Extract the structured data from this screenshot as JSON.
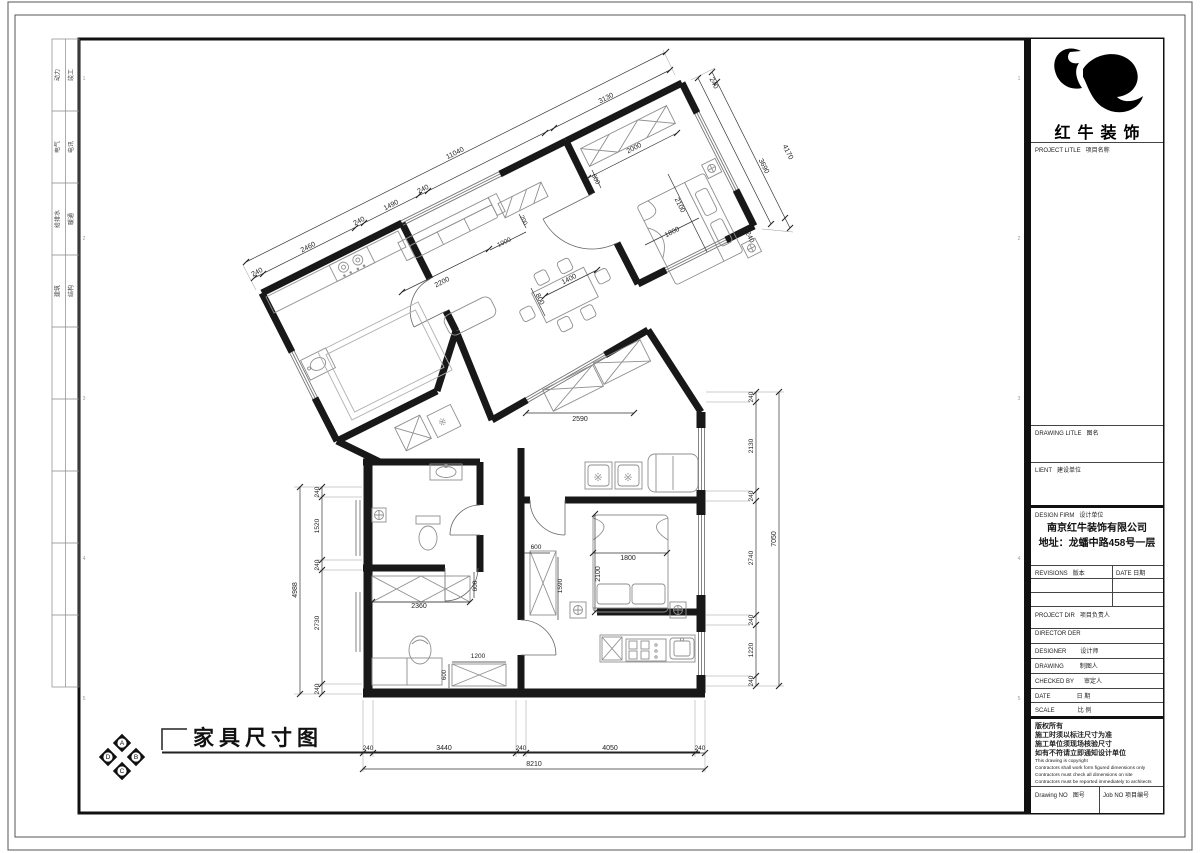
{
  "brand": {
    "name": "红牛装饰"
  },
  "title": {
    "text": "家具尺寸图"
  },
  "compass": {
    "letters": [
      "A",
      "B",
      "C",
      "D"
    ]
  },
  "disciplines": [
    [
      "动力",
      "竣工"
    ],
    [
      "电气",
      "电讯"
    ],
    [
      "给排水",
      "暖通"
    ],
    [
      "建筑",
      "结构"
    ]
  ],
  "titleblock": {
    "project_title": {
      "en": "PROJECT LITLE",
      "zh": "项目名称"
    },
    "drawing_title": {
      "en": "DRAWING LITLE",
      "zh": "图名"
    },
    "client": {
      "en": "LIENT",
      "zh": "建设单位"
    },
    "design_firm": {
      "en": "DESIGN FIRM",
      "zh": "设计单位"
    },
    "company_line1": "南京红牛装饰有限公司",
    "company_line2": "地址：龙蟠中路458号一层",
    "revisions": {
      "en": "REVISIONS",
      "zh": "版本"
    },
    "rev_date": {
      "en": "DATE",
      "zh": "日期"
    },
    "project_dir": {
      "en": "PROJECT DIR",
      "zh": "项目负责人"
    },
    "director": {
      "en": "DIRECTOR DER",
      "zh": ""
    },
    "designer": {
      "en": "DESIGNER",
      "zh": "设计师"
    },
    "drawing_by": {
      "en": "DRAWING",
      "zh": "制图人"
    },
    "checked_by": {
      "en": "CHECKED BY",
      "zh": "审定人"
    },
    "date": {
      "en": "DATE",
      "zh": "日  期"
    },
    "scale": {
      "en": "SCALE",
      "zh": "比  例"
    },
    "drawing_no": {
      "en": "Drawing NO",
      "zh": "图号"
    },
    "job_no": {
      "en": "Job NO",
      "zh": "项目编号"
    },
    "copyright_zh": [
      "版权所有",
      "施工时须以标注尺寸为准",
      "施工单位须现场核验尺寸",
      "如有不符请立即通知设计单位"
    ],
    "copyright_en": [
      "This drawing is copyright",
      "Contractors shall work form figured dimensions only",
      "Contractors must check all dimensions on site",
      "Contractors must be reported immediately to architects"
    ]
  },
  "plan_labels": [
    {
      "t": "240",
      "x": 258,
      "y": 274,
      "r": -27,
      "s": 7
    },
    {
      "t": "2460",
      "x": 309,
      "y": 249,
      "r": -27,
      "s": 7
    },
    {
      "t": "240",
      "x": 360,
      "y": 223,
      "r": -27,
      "s": 7
    },
    {
      "t": "1490",
      "x": 392,
      "y": 207,
      "r": -27,
      "s": 7
    },
    {
      "t": "240",
      "x": 424,
      "y": 191,
      "r": -27,
      "s": 7
    },
    {
      "t": "3130",
      "x": 607,
      "y": 100,
      "r": -27,
      "s": 7
    },
    {
      "t": "11040",
      "x": 456,
      "y": 155,
      "r": -27,
      "s": 7
    },
    {
      "t": "240",
      "x": 712,
      "y": 84,
      "r": 63,
      "s": 7
    },
    {
      "t": "3690",
      "x": 762,
      "y": 167,
      "r": 63,
      "s": 7
    },
    {
      "t": "4170",
      "x": 786,
      "y": 153,
      "r": 63,
      "s": 7
    },
    {
      "t": "240",
      "x": 748,
      "y": 238,
      "r": 63,
      "s": 7
    },
    {
      "t": "2000",
      "x": 635,
      "y": 150,
      "r": -27,
      "s": 7
    },
    {
      "t": "600",
      "x": 594,
      "y": 180,
      "r": 63,
      "s": 6.5
    },
    {
      "t": "2100",
      "x": 678,
      "y": 206,
      "r": 63,
      "s": 7
    },
    {
      "t": "1800",
      "x": 673,
      "y": 234,
      "r": -27,
      "s": 7
    },
    {
      "t": "2200",
      "x": 443,
      "y": 284,
      "r": -27,
      "s": 7
    },
    {
      "t": "1000",
      "x": 505,
      "y": 244,
      "r": -27,
      "s": 6.5
    },
    {
      "t": "200",
      "x": 522,
      "y": 221,
      "r": 63,
      "s": 6
    },
    {
      "t": "1400",
      "x": 570,
      "y": 281,
      "r": -27,
      "s": 7
    },
    {
      "t": "800",
      "x": 538,
      "y": 300,
      "r": 63,
      "s": 7
    },
    {
      "t": "2590",
      "x": 580,
      "y": 421,
      "r": 0,
      "s": 7
    },
    {
      "t": "600",
      "x": 536,
      "y": 549,
      "r": 0,
      "s": 6.5
    },
    {
      "t": "1590",
      "x": 562,
      "y": 586,
      "r": -90,
      "s": 6.5
    },
    {
      "t": "1800",
      "x": 628,
      "y": 560,
      "r": 0,
      "s": 7
    },
    {
      "t": "2100",
      "x": 600,
      "y": 574,
      "r": -90,
      "s": 7
    },
    {
      "t": "2360",
      "x": 419,
      "y": 608,
      "r": 0,
      "s": 7
    },
    {
      "t": "600",
      "x": 477,
      "y": 586,
      "r": -90,
      "s": 6.5
    },
    {
      "t": "1200",
      "x": 478,
      "y": 658,
      "r": 0,
      "s": 6.5
    },
    {
      "t": "600",
      "x": 446,
      "y": 675,
      "r": -90,
      "s": 6
    },
    {
      "t": "240",
      "x": 319,
      "y": 492,
      "r": -90,
      "s": 6.5
    },
    {
      "t": "1520",
      "x": 319,
      "y": 526,
      "r": -90,
      "s": 6.5
    },
    {
      "t": "240",
      "x": 319,
      "y": 565,
      "r": -90,
      "s": 6.5
    },
    {
      "t": "2730",
      "x": 319,
      "y": 623,
      "r": -90,
      "s": 6.5
    },
    {
      "t": "240",
      "x": 319,
      "y": 689,
      "r": -90,
      "s": 6.5
    },
    {
      "t": "4988",
      "x": 297,
      "y": 590,
      "r": -90,
      "s": 7
    },
    {
      "t": "240",
      "x": 753,
      "y": 397,
      "r": -90,
      "s": 6.5
    },
    {
      "t": "2130",
      "x": 753,
      "y": 446,
      "r": -90,
      "s": 6.5
    },
    {
      "t": "240",
      "x": 753,
      "y": 496,
      "r": -90,
      "s": 6.5
    },
    {
      "t": "2740",
      "x": 753,
      "y": 558,
      "r": -90,
      "s": 6.5
    },
    {
      "t": "240",
      "x": 753,
      "y": 620,
      "r": -90,
      "s": 6.5
    },
    {
      "t": "1220",
      "x": 753,
      "y": 650,
      "r": -90,
      "s": 6.5
    },
    {
      "t": "240",
      "x": 753,
      "y": 681,
      "r": -90,
      "s": 6.5
    },
    {
      "t": "7050",
      "x": 776,
      "y": 539,
      "r": -90,
      "s": 7
    },
    {
      "t": "240",
      "x": 368,
      "y": 750,
      "r": 0,
      "s": 6.5
    },
    {
      "t": "3440",
      "x": 444,
      "y": 750,
      "r": 0,
      "s": 7
    },
    {
      "t": "240",
      "x": 521,
      "y": 750,
      "r": 0,
      "s": 6.5
    },
    {
      "t": "4050",
      "x": 610,
      "y": 750,
      "r": 0,
      "s": 7
    },
    {
      "t": "240",
      "x": 700,
      "y": 750,
      "r": 0,
      "s": 6.5
    },
    {
      "t": "8210",
      "x": 534,
      "y": 766,
      "r": 0,
      "s": 7
    },
    {
      "t": "※",
      "x": 598,
      "y": 481,
      "r": 0,
      "s": 11,
      "c": "#999"
    },
    {
      "t": "※",
      "x": 628,
      "y": 481,
      "r": 0,
      "s": 11,
      "c": "#999"
    },
    {
      "t": "※",
      "x": 444,
      "y": 425,
      "r": -27,
      "s": 10,
      "c": "#999"
    },
    {
      "t": "1",
      "x": 84,
      "y": 80,
      "r": 0,
      "s": 5,
      "c": "#999"
    },
    {
      "t": "2",
      "x": 84,
      "y": 240,
      "r": 0,
      "s": 5,
      "c": "#999"
    },
    {
      "t": "3",
      "x": 84,
      "y": 400,
      "r": 0,
      "s": 5,
      "c": "#999"
    },
    {
      "t": "4",
      "x": 84,
      "y": 560,
      "r": 0,
      "s": 5,
      "c": "#999"
    },
    {
      "t": "5",
      "x": 84,
      "y": 700,
      "r": 0,
      "s": 5,
      "c": "#999"
    },
    {
      "t": "1",
      "x": 1019,
      "y": 80,
      "r": 0,
      "s": 5,
      "c": "#999"
    },
    {
      "t": "2",
      "x": 1019,
      "y": 240,
      "r": 0,
      "s": 5,
      "c": "#999"
    },
    {
      "t": "3",
      "x": 1019,
      "y": 400,
      "r": 0,
      "s": 5,
      "c": "#999"
    },
    {
      "t": "4",
      "x": 1019,
      "y": 560,
      "r": 0,
      "s": 5,
      "c": "#999"
    },
    {
      "t": "5",
      "x": 1019,
      "y": 700,
      "r": 0,
      "s": 5,
      "c": "#999"
    }
  ]
}
